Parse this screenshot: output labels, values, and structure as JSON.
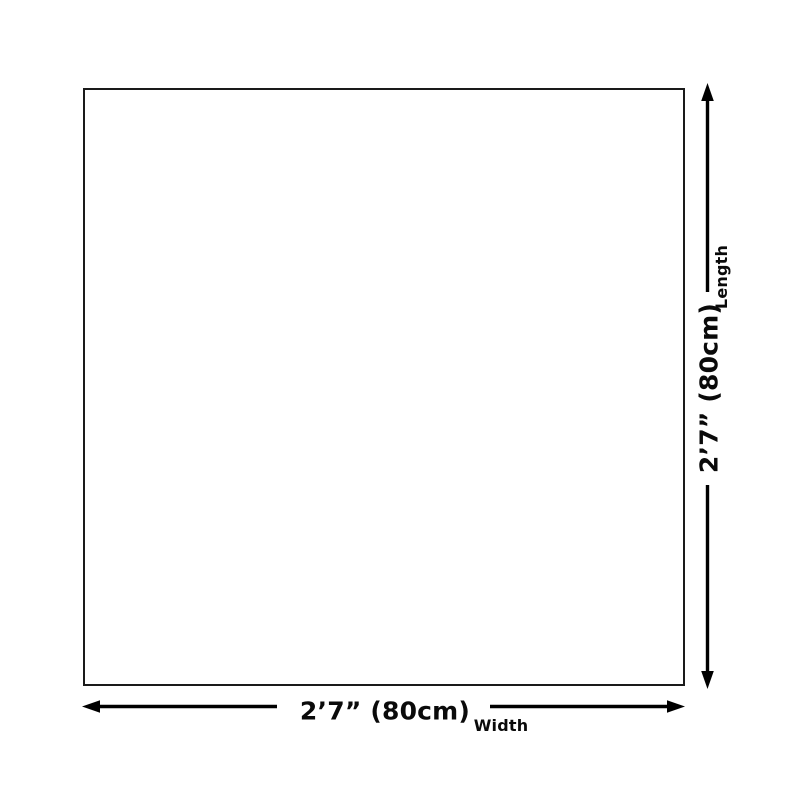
{
  "diagram": {
    "colors": {
      "ink": "#0a0a0a",
      "frame": "#1a1a1a",
      "arrow": "#000000",
      "background": "#ffffff"
    },
    "length": {
      "value": "2’7” (80cm)",
      "label": "Length",
      "icon": "double-arrow-vertical-icon"
    },
    "width": {
      "value": "2’7” (80cm)",
      "label": "Width",
      "icon": "double-arrow-horizontal-icon"
    }
  }
}
